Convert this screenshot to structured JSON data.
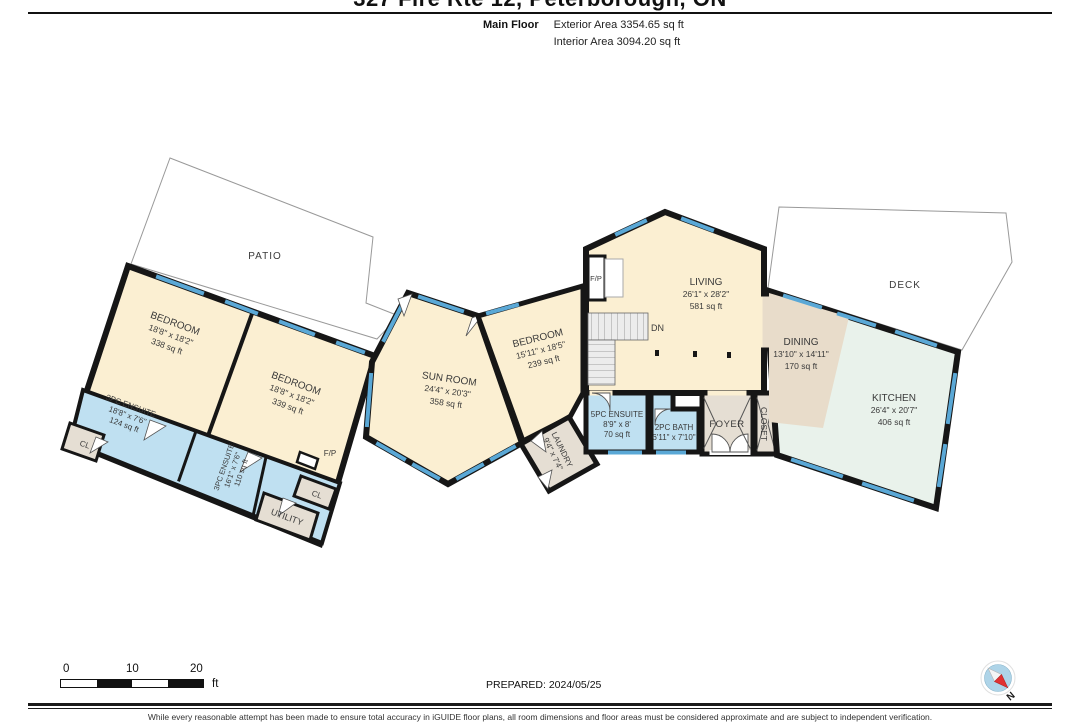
{
  "header": {
    "title": "327 Fire Rte 12, Peterborough, ON",
    "floor_label": "Main Floor",
    "exterior_area": "Exterior Area 3354.65 sq ft",
    "interior_area": "Interior Area 3094.20 sq ft"
  },
  "rooms": {
    "patio": {
      "name": "PATIO"
    },
    "deck": {
      "name": "DECK"
    },
    "bedroom1": {
      "name": "BEDROOM",
      "dims": "18'8\" x 18'2\"",
      "area": "338 sq ft"
    },
    "bedroom2": {
      "name": "BEDROOM",
      "dims": "18'8\" x 18'2\"",
      "area": "339 sq ft"
    },
    "ensuite3pc_a": {
      "name": "3PC ENSUITE",
      "dims": "18'8\" x 7'6\"",
      "area": "124 sq ft"
    },
    "closet_a": {
      "name": "CL"
    },
    "ensuite3pc_b": {
      "name": "3PC ENSUITE",
      "dims": "16'1\" x 7'6\"",
      "area": "110 sq ft"
    },
    "utility": {
      "name": "UTILITY"
    },
    "closet_b": {
      "name": "CL"
    },
    "fireplace_a": {
      "name": "F/P"
    },
    "sunroom": {
      "name": "SUN ROOM",
      "dims": "24'4\" x 20'3\"",
      "area": "358 sq ft"
    },
    "bedroom3": {
      "name": "BEDROOM",
      "dims": "15'11\" x 18'5\"",
      "area": "239 sq ft"
    },
    "laundry": {
      "name": "LAUNDRY",
      "dims": "9'4\" x 7'4\""
    },
    "ensuite5pc": {
      "name": "5PC ENSUITE",
      "dims": "8'9\" x 8'",
      "area": "70 sq ft"
    },
    "bath2pc": {
      "name": "2PC BATH",
      "dims": "6'11\" x 7'10\""
    },
    "foyer": {
      "name": "FOYER"
    },
    "closet_c": {
      "name": "CLOSET"
    },
    "living": {
      "name": "LIVING",
      "dims": "26'1\" x 28'2\"",
      "area": "581 sq ft"
    },
    "stairs": {
      "label": "DN"
    },
    "fireplace_b": {
      "name": "F/P"
    },
    "dining": {
      "name": "DINING",
      "dims": "13'10\" x 14'11\"",
      "area": "170 sq ft"
    },
    "kitchen": {
      "name": "KITCHEN",
      "dims": "26'4\" x 20'7\"",
      "area": "406 sq ft"
    }
  },
  "footer": {
    "scale": {
      "ticks": [
        "0",
        "10",
        "20"
      ],
      "unit": "ft"
    },
    "prepared": "PREPARED: 2024/05/25",
    "compass_label": "N",
    "disclaimer": "While every reasonable attempt has been made to ensure total accuracy in iGUIDE floor plans, all room dimensions and floor areas must be considered approximate and are subject to independent verification."
  },
  "colors": {
    "room_cream": "#FBEFD2",
    "room_blue": "#BFE0F1",
    "room_gray": "#E5DED3",
    "room_tan": "#E8DCCA",
    "room_mint": "#E9F2EB",
    "wall": "#161616",
    "window": "#5AA8D6",
    "compass_red": "#E03131",
    "compass_blue": "#AED4E8"
  }
}
